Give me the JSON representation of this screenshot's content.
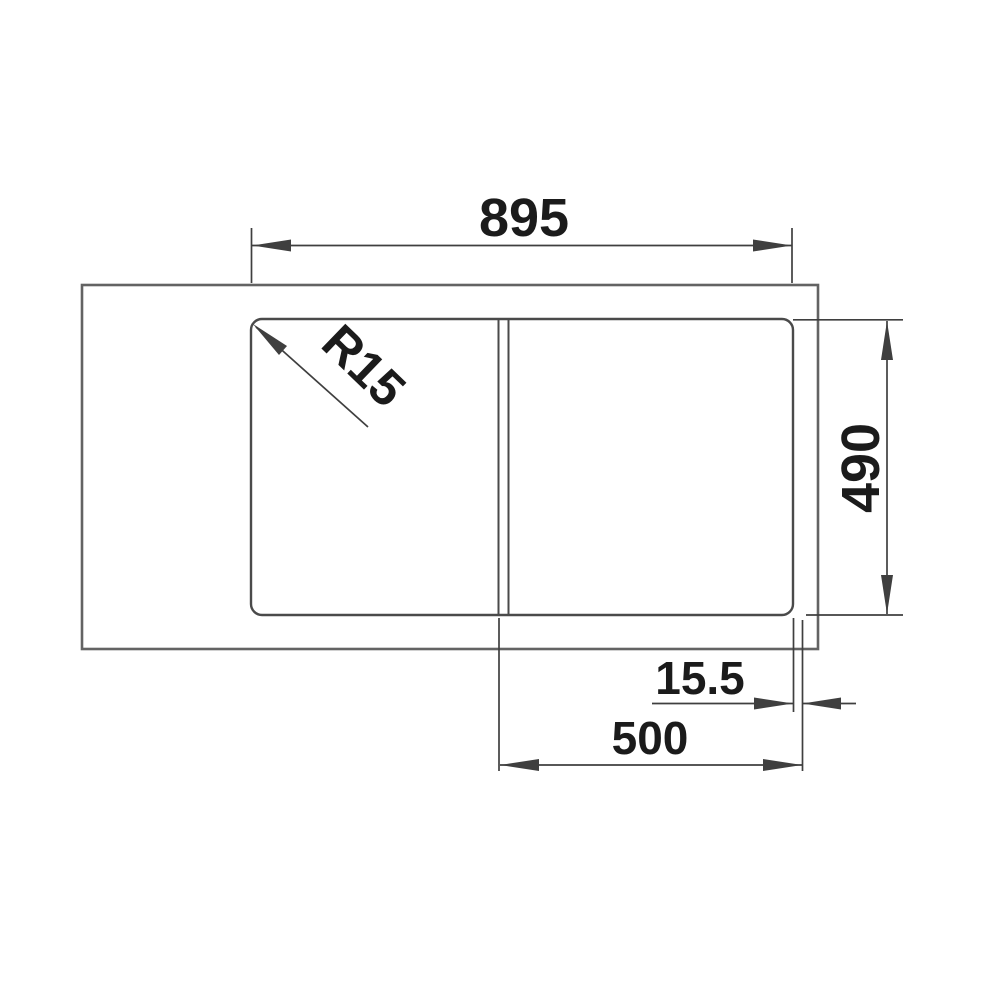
{
  "drawing": {
    "type": "technical-dimension-drawing",
    "subject": "sink-top-view-with-bowl-and-drainer",
    "labels": {
      "overall_width": "895",
      "bowl_depth": "490",
      "edge_offset": "15.5",
      "bowl_width": "500",
      "corner_radius": "R15"
    },
    "dimensions_mm": {
      "overall_width": 895,
      "bowl_depth": 490,
      "edge_offset": 15.5,
      "bowl_width": 500,
      "corner_radius": 15
    },
    "colors": {
      "background": "#ffffff",
      "outline": "#636363",
      "cutout_outline": "#4a4a4a",
      "dimension_line": "#3f3f3f",
      "text": "#1b1b1b"
    }
  }
}
